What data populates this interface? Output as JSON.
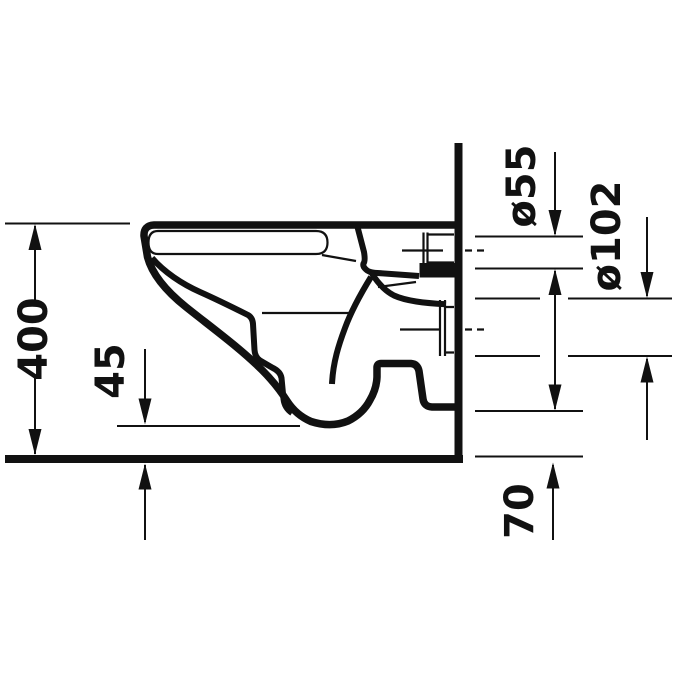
{
  "drawing": {
    "kind": "technical-dimension-drawing",
    "subject": "wall-hung toilet, side elevation",
    "background_color": "#ffffff",
    "line_color": "#111111",
    "labels": {
      "height_400": "400",
      "clearance_45": "45",
      "inlet_55": "ø55",
      "outlet_102": "ø102",
      "bottom_70": "70"
    }
  }
}
